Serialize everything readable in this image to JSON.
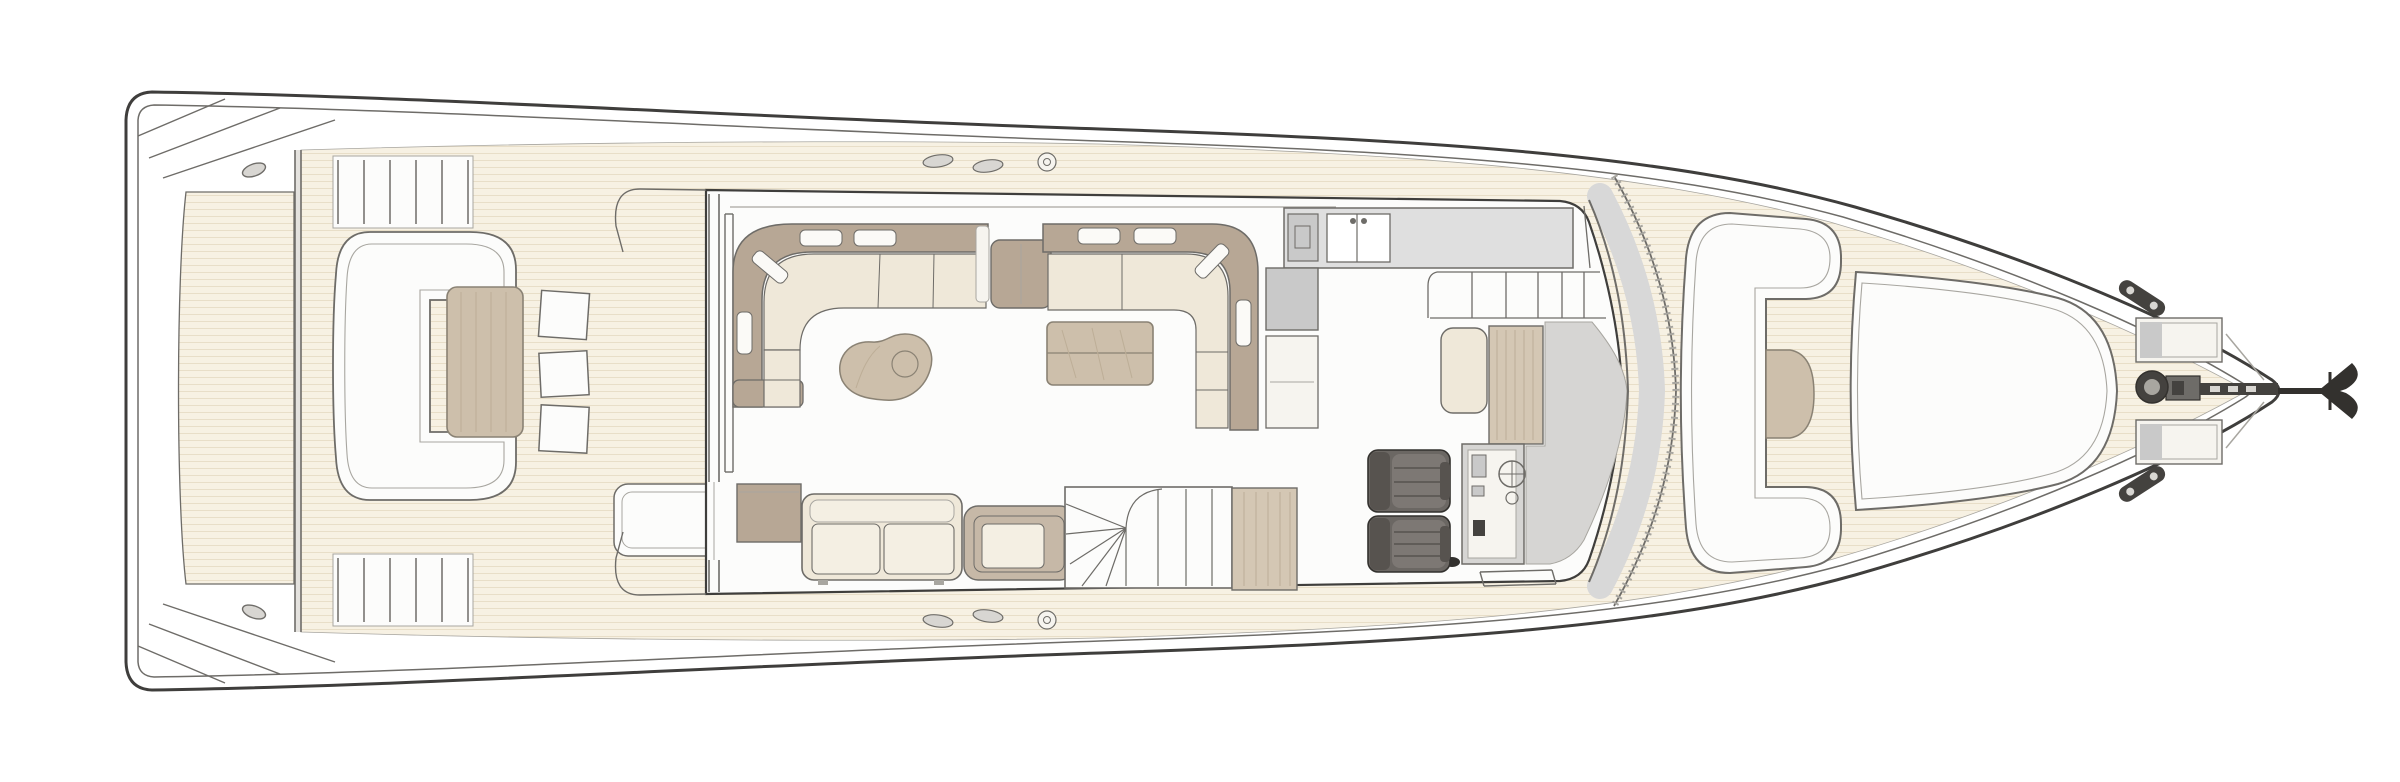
{
  "diagram": {
    "title": "Motor yacht main deck floor plan — overhead line drawing, bow to the right",
    "type": "floor-plan",
    "orientation": {
      "bow": "right",
      "stern": "left"
    }
  },
  "palette": {
    "line_dark": "#3f3e3c",
    "line_mid": "#6e6c68",
    "line_soft": "#a8a6a0",
    "hull_white": "#ffffff",
    "interior_white": "#fcfcfb",
    "panel_white": "#f6f4ef",
    "teak": "#f7f1e3",
    "teak_line": "#e8dec8",
    "transom_gray": "#e4e2de",
    "cushion": "#efe8d9",
    "cushion_light": "#f4efe3",
    "pillow_white": "#fbfaf7",
    "upholstery": "#b7a795",
    "upholstery_soft": "#c6b8a7",
    "wood": "#d4c7b4",
    "wood_grain": "#bdae97",
    "table_wood": "#cdbfab",
    "table_edge": "#8a8274",
    "counter": "#dfdfdf",
    "appliance": "#c9c9c9",
    "glass_band": "#d8d8d8",
    "dash_gray": "#d6d5d3",
    "seat_dark": "#6b6763",
    "seat_dark_back": "#57534f",
    "seat_dark_cushion": "#7d7874",
    "seat_edge": "#33312e",
    "hardware_dark": "#44423f",
    "hardware_mid": "#6e6c68",
    "hardware_light": "#d8d6d2"
  },
  "zones": [
    {
      "id": "swim-platform"
    },
    {
      "id": "aft-cockpit",
      "furniture": [
        "curved-bench",
        "cockpit-table",
        "stool-1",
        "stool-2",
        "stool-3",
        "boarding-step"
      ]
    },
    {
      "id": "salon",
      "furniture": [
        "port-l-sofa",
        "kidney-coffee-table",
        "side-cabinet",
        "starboard-sofa",
        "sideboard",
        "armchair"
      ]
    },
    {
      "id": "dining",
      "furniture": [
        "l-banquette",
        "dining-table"
      ]
    },
    {
      "id": "galley",
      "furniture": [
        "counter",
        "sink",
        "cooktop",
        "refrigerator",
        "lower-cabinet"
      ]
    },
    {
      "id": "stairwell",
      "furniture": [
        "curved-stairs",
        "joinery-block"
      ]
    },
    {
      "id": "helm",
      "furniture": [
        "helm-seat-port",
        "helm-seat-starboard",
        "console",
        "companion-bench",
        "dashboard",
        "windshield"
      ]
    },
    {
      "id": "foredeck",
      "furniture": [
        "c-lounge",
        "foredeck-table",
        "backrest-block",
        "bow-sunpad"
      ]
    },
    {
      "id": "bow",
      "hardware": [
        "deck-hatch-port",
        "deck-hatch-starboard",
        "cleat-port",
        "cleat-starboard",
        "windlass",
        "anchor-chain",
        "anchor"
      ]
    }
  ]
}
